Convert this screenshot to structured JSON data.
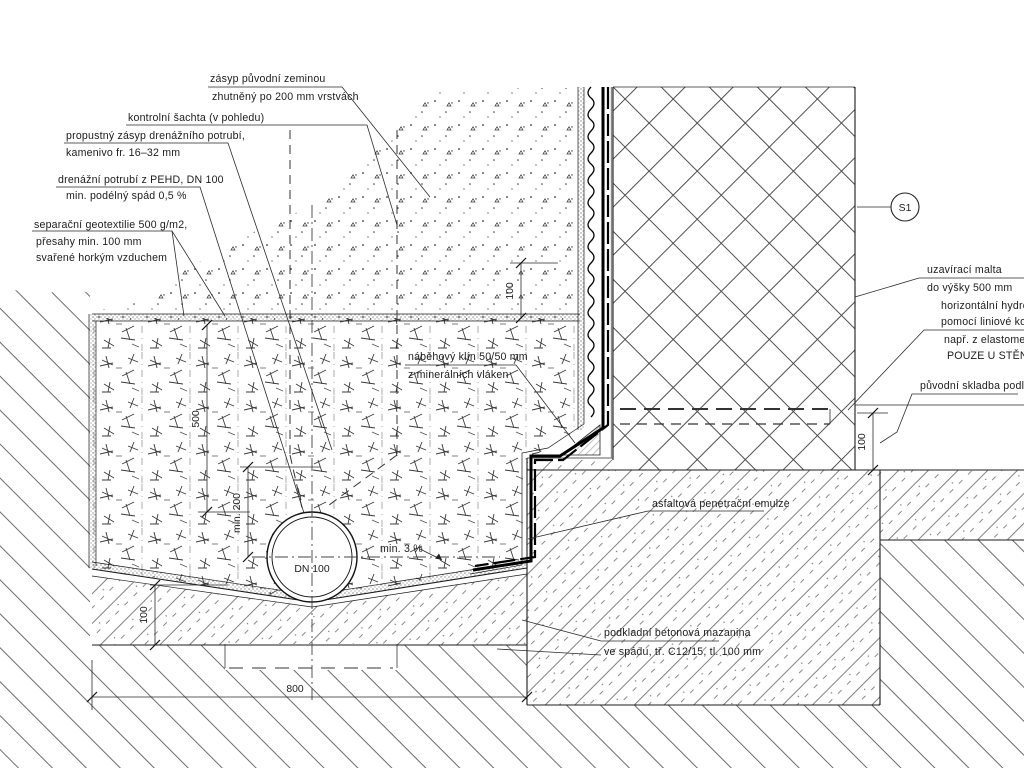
{
  "drawing": {
    "title_hint": "detail drenáže u stěny sklepa",
    "labels": {
      "backfill": {
        "l1": "zásyp původní zeminou",
        "l2": "zhutněný po 200 mm vrstvách"
      },
      "shaft": {
        "l1": "kontrolní šachta (v pohledu)"
      },
      "gravel": {
        "l1": "propustný zásyp drenážního potrubí,",
        "l2": "kamenivo fr. 16–32 mm"
      },
      "drainpipe": {
        "l1": "drenážní potrubí z PEHD, DN 100",
        "l2": "min. podélný spád 0,5 %"
      },
      "geotextile": {
        "l1": "separační geotextilie 500 g/m2,",
        "l2": "přesahy min. 100 mm",
        "l3": "svařené horkým vzduchem"
      },
      "wedge": {
        "l1": "náběhový klín 50/50 mm",
        "l2": "z minerálních vláken"
      },
      "mortar": {
        "l1": "uzavírací malta",
        "l2": "do výšky 500 mm"
      },
      "injection": {
        "l1": "horizontální hydroizolační",
        "l2": "pomocí liniové kontaktní",
        "l3": "např. z elastomerových",
        "l4": "POUZE U STĚNY SKLEPA"
      },
      "floor": {
        "l1": "původní skladba podlahy"
      },
      "emulsion": {
        "l1": "asfaltová penetrační emulze"
      },
      "screed": {
        "l1": "podkladní betonová mazanina",
        "l2": "ve spádu, tř. C12/15, tl. 100 mm"
      },
      "slope": {
        "l1": "min. 3 %"
      },
      "pipe_dn": "DN 100",
      "section_mark": "S1"
    },
    "dimensions": {
      "top_overlap": "100",
      "trench_depth": "500",
      "pipe_cover": "min. 200",
      "base_thickness": "100",
      "trench_width": "800",
      "floor_thickness": "100"
    },
    "colors": {
      "line": "#1c1c1c",
      "hatch": "#666666",
      "background": "#ffffff"
    }
  }
}
